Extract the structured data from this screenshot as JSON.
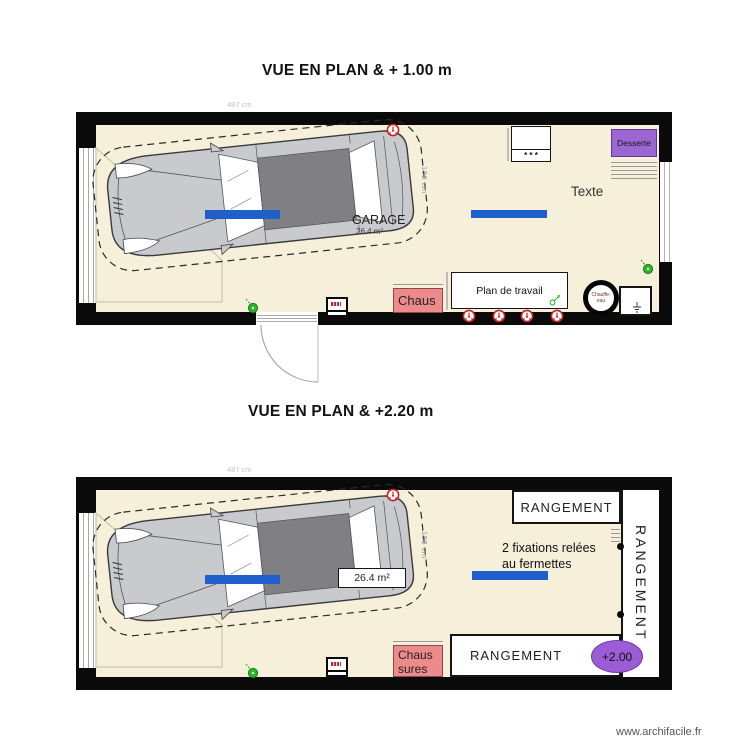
{
  "watermark": "www.archifacile.fr",
  "colors": {
    "floor": "#F6F0DA",
    "wall": "#0A0A0A",
    "accent_blue": "#1F5FCC",
    "purple": "#9A66D2",
    "pink": "#ED8B8B",
    "green": "#2DB52D",
    "outlet_red": "#C42222",
    "car_roof_gray": "#7F7F84",
    "car_body_gray": "#C9CACE"
  },
  "plan1": {
    "title": "VUE EN PLAN & + 1.00 m",
    "dim_top": "487 cm",
    "dim_side": "188 cm",
    "room_name": "GARAGE",
    "room_area": "26,4 m²",
    "freezer_marks": "* * *",
    "desserte_label": "Desserte",
    "text_label": "Texte",
    "worktop_label": "Plan de travail",
    "shoes_label": "Chaus",
    "heater_line1": "Chauffe-",
    "heater_line2": "eau"
  },
  "plan2": {
    "title": "VUE EN PLAN & +2.20 m",
    "dim_top": "487 cm",
    "dim_side": "188 cm",
    "area_label": "26.4 m²",
    "storage_top": "RANGEMENT",
    "storage_side": "RANGEMENT",
    "storage_bottom": "RANGEMENT",
    "note_line1": "2 fixations relées",
    "note_line2": "au fermettes",
    "elevation_label": "+2.00",
    "shoes_line1": "Chaus",
    "shoes_line2": "sures"
  }
}
